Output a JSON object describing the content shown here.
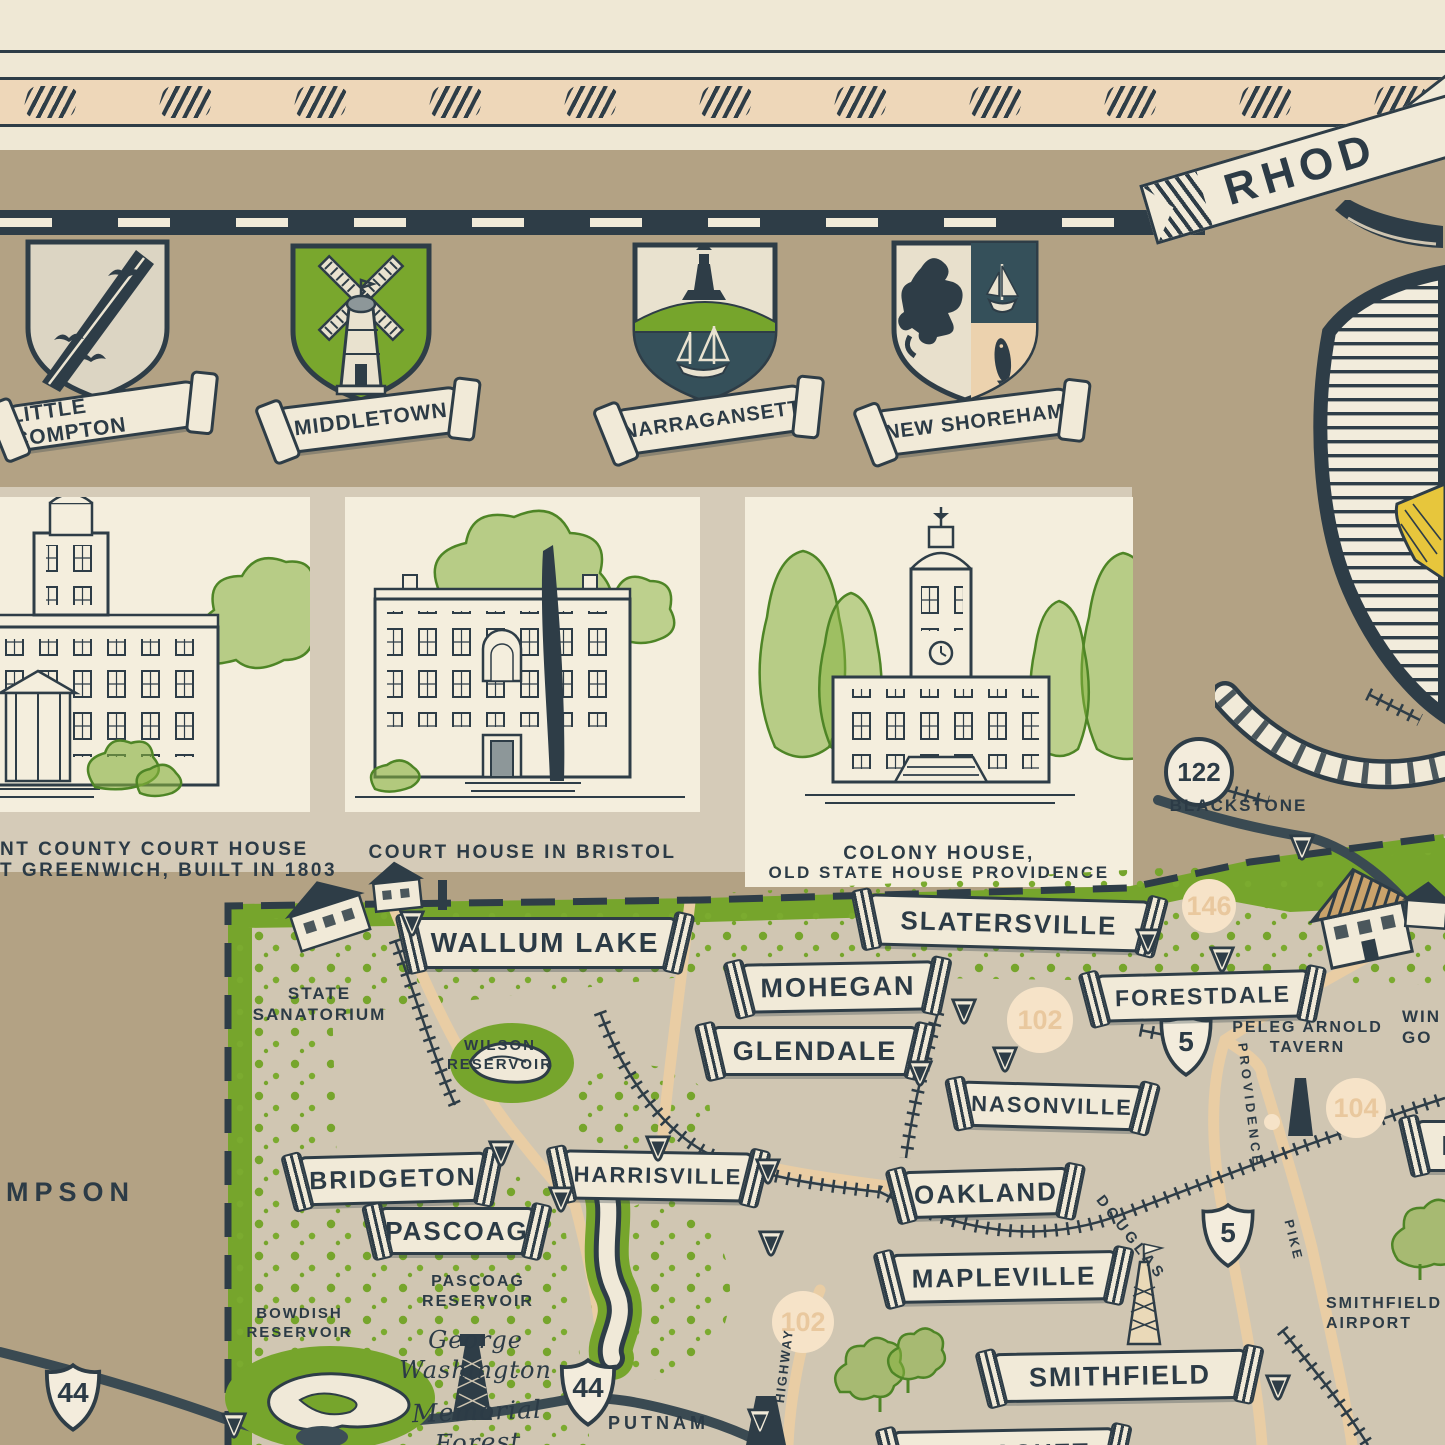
{
  "palette": {
    "ink": "#2e3d47",
    "cream_paper": "#efe8d5",
    "peach_band": "#eed7b9",
    "header_tan": "#b3a284",
    "card_tan": "#d5cbb8",
    "map_interior": "#d0c6b2",
    "vegetation_green": "#76a52c",
    "crest_green": "#79a72d",
    "banner_cream": "#f1ead8",
    "anchor_yellow": "#e7c63c",
    "road_peach": "#e9cda4",
    "faint_marker": "#f6e3c8"
  },
  "header": {
    "ribbon_text": "RHOD",
    "crests": [
      {
        "label": "LITTLE COMPTON"
      },
      {
        "label": "MIDDLETOWN"
      },
      {
        "label": "NARRAGANSETT"
      },
      {
        "label": "NEW SHOREHAM"
      }
    ]
  },
  "panels": [
    {
      "caption1": "NT COUNTY COURT HOUSE",
      "caption2": "T GREENWICH, BUILT IN 1803"
    },
    {
      "caption1": "COURT HOUSE IN BRISTOL",
      "caption2": ""
    },
    {
      "caption1": "COLONY HOUSE,",
      "caption2": "OLD STATE HOUSE  PROVIDENCE"
    }
  ],
  "map": {
    "towns": {
      "wallum_lake": "WALLUM LAKE",
      "slatersville": "SLATERSVILLE",
      "mohegan": "MOHEGAN",
      "glendale": "GLENDALE",
      "nasonville": "NASONVILLE",
      "forestdale": "FORESTDALE",
      "bridgeton": "BRIDGETON",
      "pascoag": "PASCOAG",
      "harrisville": "HARRISVILLE",
      "oakland": "OAKLAND",
      "mapleville": "MAPLEVILLE",
      "smithfield": "SMITHFIELD",
      "partial_right": "M",
      "partial_bottom": "CHEPACHET"
    },
    "labels": {
      "blackstone": "BLACKSTONE",
      "state_sanatorium": "STATE\nSANATORIUM",
      "wilson_reservoir": "WILSON\nRESERVOIR",
      "pascoag_reservoir": "PASCOAG\nRESERVOIR",
      "bowdish_reservoir": "BOWDISH\nRESERVOIR",
      "george_washington": "George\nWashington",
      "memorial_forest": "Memorial Forest",
      "putnam": "PUTNAM",
      "thompson_partial": "MPSON",
      "peleg_arnold_tavern": "PELEG ARNOLD\nTAVERN",
      "smithfield_airport": "SMITHFIELD\nAIRPORT",
      "win_go_partial": "WIN\nGO",
      "douglas": "DOUGLAS",
      "providence": "PROVIDENCE",
      "pike": "PIKE",
      "highway": "HIGHWAY"
    },
    "routes": {
      "us44": "44",
      "us5": "5",
      "r122": "122",
      "r102": "102",
      "r146": "146",
      "r104": "104"
    }
  }
}
